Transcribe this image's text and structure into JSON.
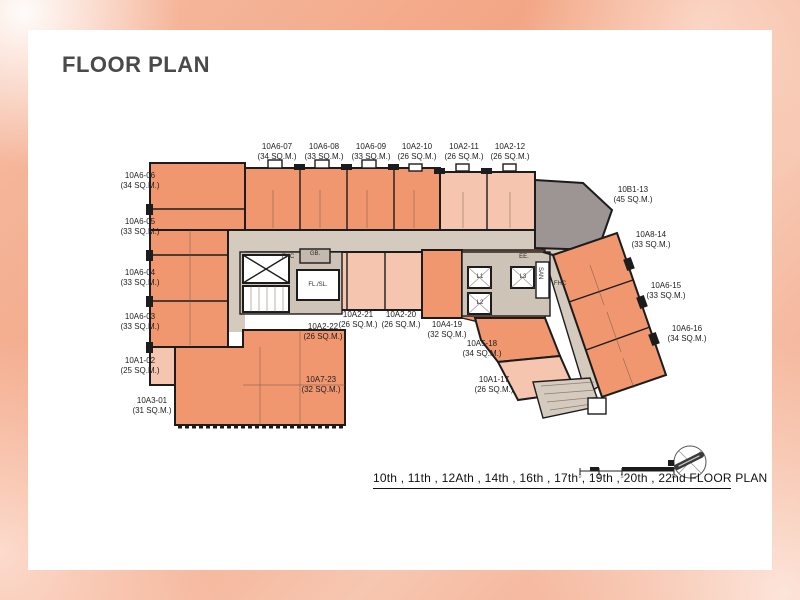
{
  "page": {
    "title": "FLOOR PLAN"
  },
  "colors": {
    "salmon": "#f0976f",
    "lightpink": "#f6c5af",
    "gray": "#9d9593",
    "corridor": "#d4cabe",
    "corefloor": "#cdc3b7",
    "wall": "#1c1c1c",
    "background_peach": "#f3a685",
    "card": "#ffffff"
  },
  "plan": {
    "units": [
      {
        "id": "10A6-06",
        "area": "(34 SQ.M.)"
      },
      {
        "id": "10A6-05",
        "area": "(33 SQ.M.)"
      },
      {
        "id": "10A6-04",
        "area": "(33 SQ.M.)"
      },
      {
        "id": "10A6-03",
        "area": "(33 SQ.M.)"
      },
      {
        "id": "10A1-02",
        "area": "(25 SQ.M.)"
      },
      {
        "id": "10A3-01",
        "area": "(31 SQ.M.)"
      },
      {
        "id": "10A6-07",
        "area": "(34 SQ.M.)"
      },
      {
        "id": "10A6-08",
        "area": "(33 SQ.M.)"
      },
      {
        "id": "10A6-09",
        "area": "(33 SQ.M.)"
      },
      {
        "id": "10A2-10",
        "area": "(26 SQ.M.)"
      },
      {
        "id": "10A2-11",
        "area": "(26 SQ.M.)"
      },
      {
        "id": "10A2-12",
        "area": "(26 SQ.M.)"
      },
      {
        "id": "10B1-13",
        "area": "(45 SQ.M.)"
      },
      {
        "id": "10A8-14",
        "area": "(33 SQ.M.)"
      },
      {
        "id": "10A6-15",
        "area": "(33 SQ.M.)"
      },
      {
        "id": "10A6-16",
        "area": "(34 SQ.M.)"
      },
      {
        "id": "10A2-22",
        "area": "(26 SQ.M.)"
      },
      {
        "id": "10A2-21",
        "area": "(26 SQ.M.)"
      },
      {
        "id": "10A2-20",
        "area": "(26 SQ.M.)"
      },
      {
        "id": "10A4-19",
        "area": "(32 SQ.M.)"
      },
      {
        "id": "10A5-18",
        "area": "(34 SQ.M.)"
      },
      {
        "id": "10A1-17",
        "area": "(26 SQ.M.)"
      },
      {
        "id": "10A7-23",
        "area": "(32 SQ.M.)"
      }
    ],
    "core_labels": {
      "fhc_left": "FHC",
      "gb": "GB.",
      "lift_left": "FL./SL.",
      "ee": "EE.",
      "l1": "L1",
      "l2": "L2",
      "l3": "L3",
      "san": "SAN",
      "fhc_right": "FHC"
    },
    "caption": "10th , 11th , 12Ath , 14th , 16th , 17th , 19th , 20th , 22nd FLOOR PLAN",
    "scale_ticks": {
      "t0": "0",
      "t1": "2",
      "t2": "5",
      "t3": "10"
    }
  }
}
